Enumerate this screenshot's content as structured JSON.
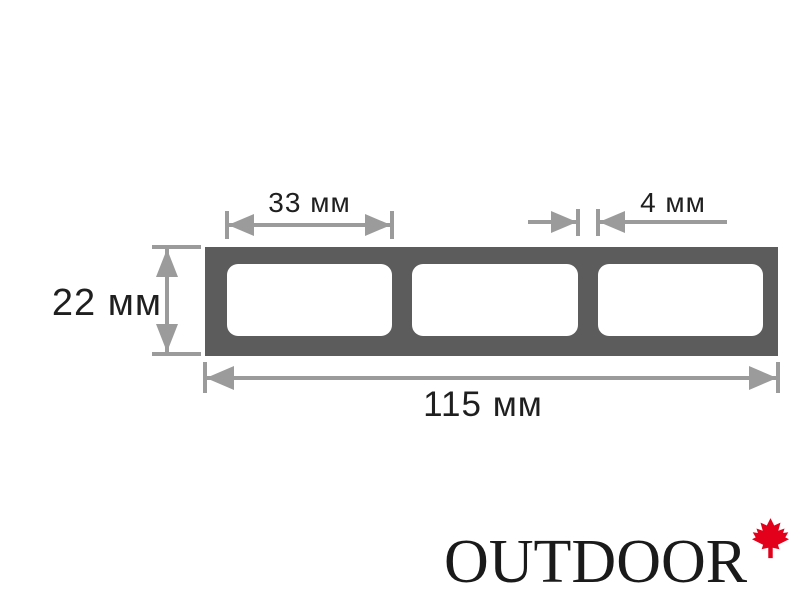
{
  "diagram": {
    "dimensions": {
      "chamber_width": "33 мм",
      "wall_thickness": "4 мм",
      "profile_height": "22 мм",
      "total_width": "115 мм"
    },
    "chamber_count": 3
  },
  "logo": {
    "text": "OUTDOOR",
    "icon": "maple-leaf-icon"
  },
  "colors": {
    "profile": "#5c5c5c",
    "dimension": "#9b9b9b",
    "text": "#1f1f1f",
    "leaf": "#e2001a"
  }
}
